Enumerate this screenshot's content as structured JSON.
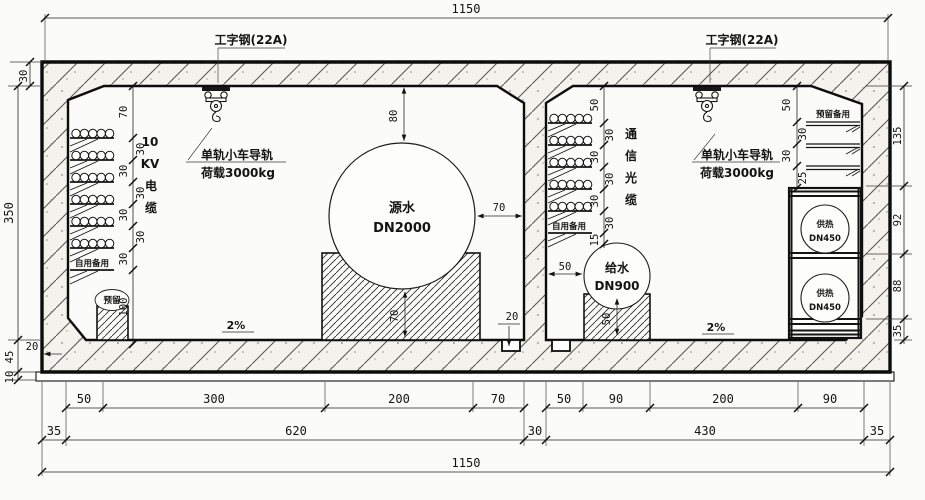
{
  "dims_top": {
    "total": "1150"
  },
  "dims_left": {
    "roof": "30",
    "height": "350",
    "curb": "20",
    "slab": "45",
    "bed": "10"
  },
  "dims_right": {
    "a": "135",
    "b": "92",
    "c": "88",
    "d": "35"
  },
  "dims_bottom": {
    "row1": [
      "50",
      "300",
      "200",
      "70",
      "50",
      "90",
      "200",
      "90"
    ],
    "row2": [
      "35",
      "620",
      "30",
      "430",
      "35"
    ],
    "total": "1150"
  },
  "cell1": {
    "ibeam": "工字钢(22A)",
    "rail1": "单轨小车导轨",
    "rail2": "荷载3000kg",
    "cable": [
      "10",
      "KV",
      "电",
      "缆"
    ],
    "chain": [
      "70",
      "30",
      "30",
      "30",
      "30",
      "30",
      "30",
      "100"
    ],
    "spare": "自用备用",
    "reserved": "预留",
    "pipe": "源水",
    "pipe_dn": "DN2000",
    "d_top": "80",
    "d_side": "70",
    "d_ped": "70",
    "d_gutter": "20",
    "slope": "2%"
  },
  "cell2": {
    "ibeam": "工字钢(22A)",
    "rail1": "单轨小车导轨",
    "rail2": "荷载3000kg",
    "cable": [
      "通",
      "信",
      "光",
      "缆"
    ],
    "chain": [
      "50",
      "30",
      "30",
      "30",
      "30",
      "30",
      "15"
    ],
    "spare": "自用备用",
    "pipe": "给水",
    "pipe_dn": "DN900",
    "d_side": "50",
    "d_ped": "50",
    "slope": "2%",
    "rtrays_label": "预留备用",
    "rchain": [
      "50",
      "30",
      "30",
      "25"
    ],
    "heat1": "供热",
    "heat1_dn": "DN450",
    "heat2": "供热",
    "heat2_dn": "DN450"
  }
}
